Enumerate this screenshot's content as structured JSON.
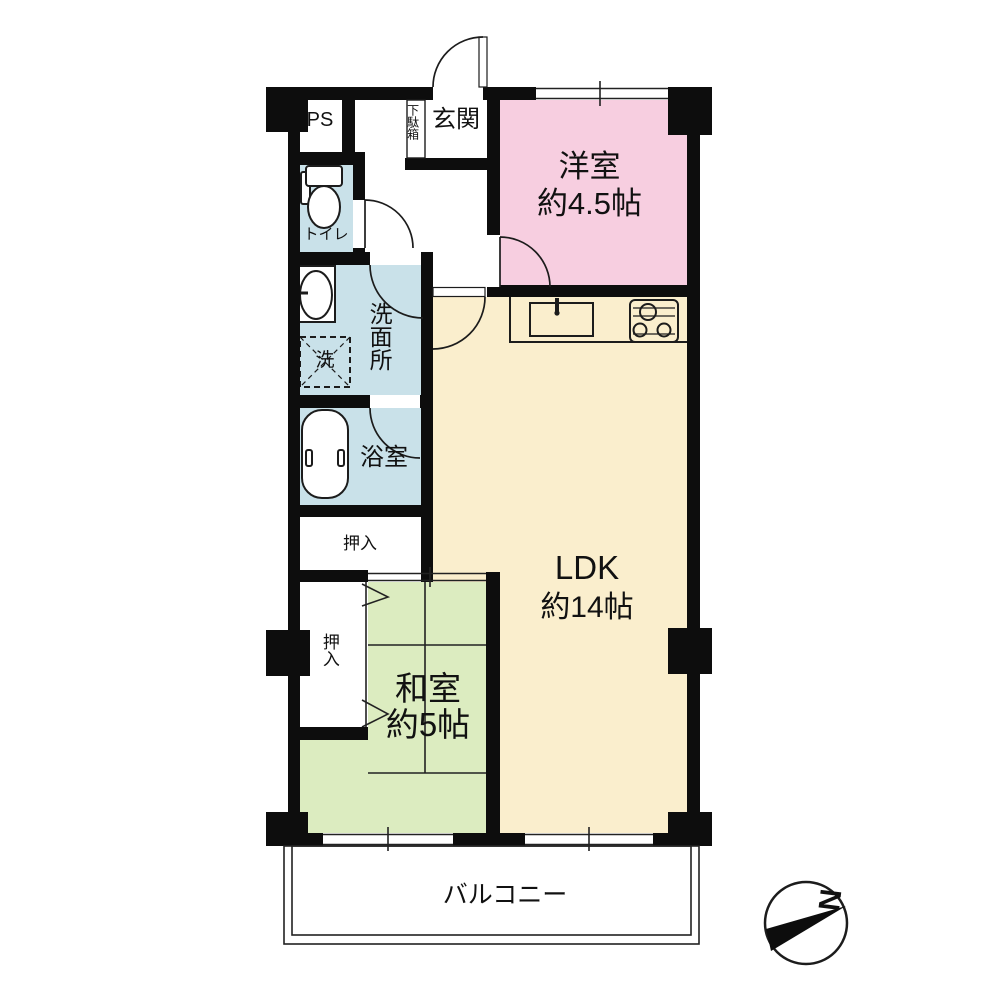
{
  "plan": {
    "rooms": {
      "pipe_space": {
        "label": "PS"
      },
      "shoe_box": {
        "label": "下駄箱"
      },
      "entrance": {
        "label": "玄関"
      },
      "western_room": {
        "label": "洋室",
        "size": "約4.5帖"
      },
      "toilet": {
        "label": "トイレ"
      },
      "washroom": {
        "label": "洗面所"
      },
      "washer_space": {
        "label": "洗"
      },
      "bathroom": {
        "label": "浴室"
      },
      "ldk": {
        "label": "LDK",
        "size": "約14帖"
      },
      "japanese_room": {
        "label": "和室",
        "size": "約5帖"
      },
      "closet_top": {
        "label": "押入"
      },
      "closet_side": {
        "label": "押入"
      },
      "balcony": {
        "label": "バルコニー"
      }
    },
    "compass": {
      "label": "N"
    },
    "colors": {
      "western_room": "#f7cee0",
      "ldk": "#faeecd",
      "japanese_room": "#dcecc0",
      "wet_area": "#c9e1e9",
      "wall": "#0d0d0d"
    }
  }
}
